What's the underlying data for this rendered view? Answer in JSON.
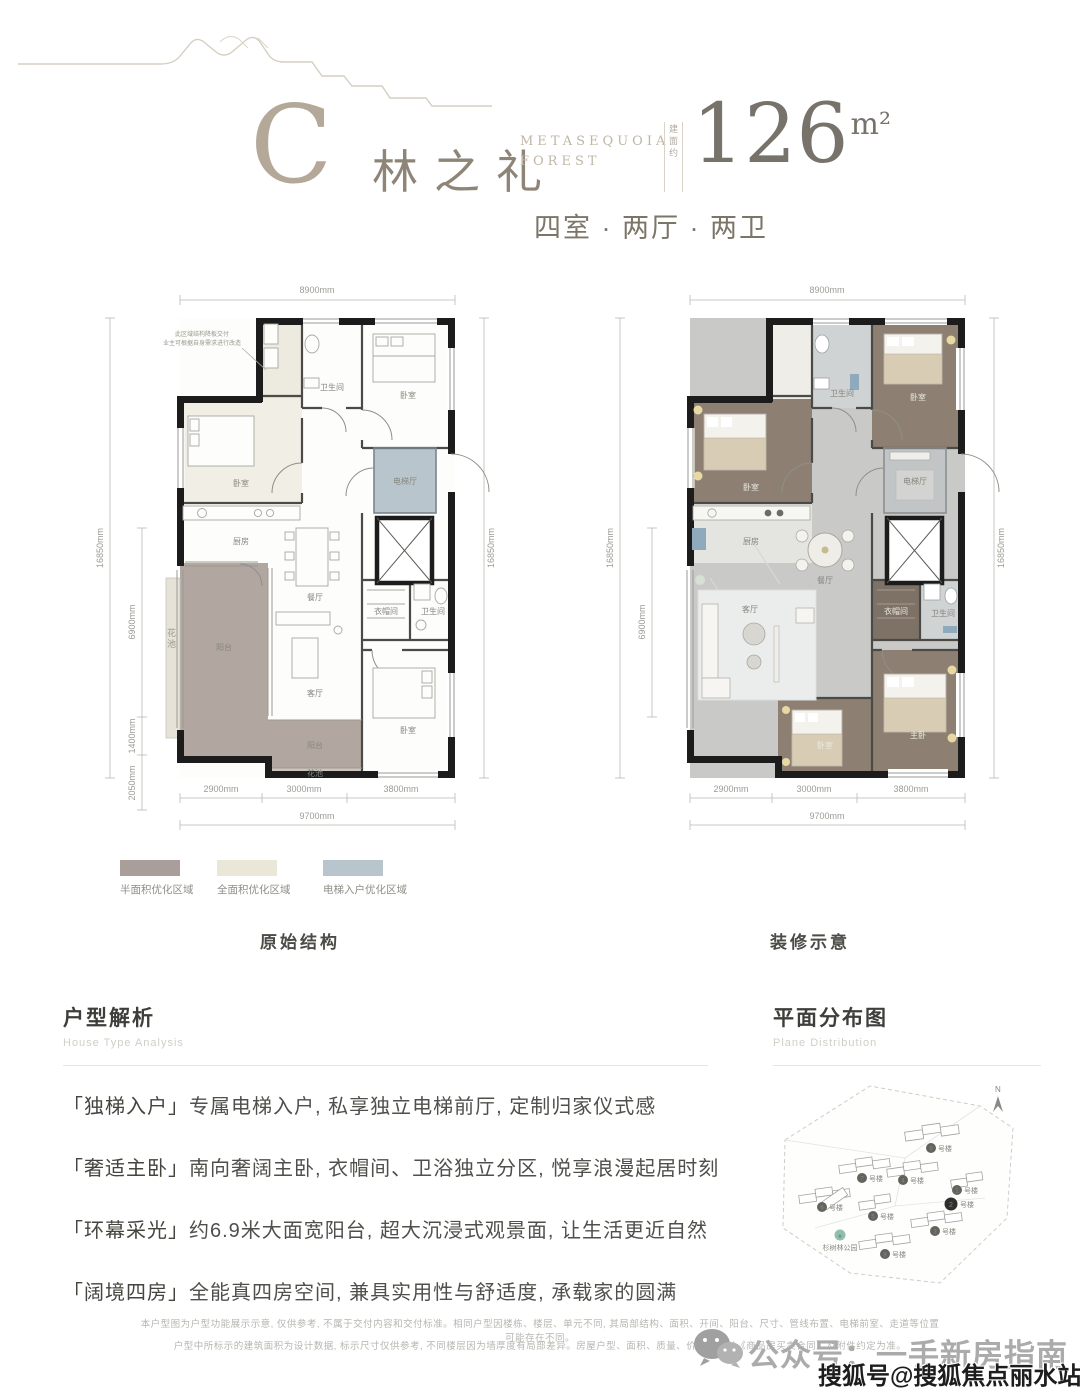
{
  "header": {
    "letter": "C",
    "name": "林之礼",
    "en_line1": "METASEQUOIA",
    "en_line2": "FOREST",
    "area_prefix": "建面约",
    "area_value": "126",
    "area_unit": "m²",
    "layout": "四室 · 两厅 · 两卫"
  },
  "plans": {
    "left": {
      "caption": "原始结构",
      "dims": {
        "top": "8900mm",
        "side": "16850mm",
        "side_inner": [
          "6900mm",
          "1400mm",
          "2050mm"
        ],
        "side_right": "16850mm",
        "bottom": [
          "2900mm",
          "3000mm",
          "3800mm"
        ],
        "bottom_total": "9700mm"
      },
      "note_line1": "此区域结构降板交付",
      "note_line2": "业主可根据自身需求进行改造",
      "rooms": {
        "bath_top": "卫生间",
        "bed_top": "卧室",
        "bed_left": "卧室",
        "kitchen": "厨房",
        "dining": "餐厅",
        "lift_hall": "电梯厅",
        "balcony": "阳台",
        "living": "客厅",
        "cloak": "衣帽间",
        "bath_mid": "卫生间",
        "bed_bottom": "卧室",
        "balcony_south": "阳台",
        "flower_south": "花池",
        "flower_west": "花池"
      }
    },
    "right": {
      "caption": "装修示意",
      "dims": {
        "top": "8900mm",
        "side": "16850mm",
        "side_inner": [
          "6900mm"
        ],
        "side_right": "16850mm",
        "bottom": [
          "2900mm",
          "3000mm",
          "3800mm"
        ],
        "bottom_total": "9700mm"
      },
      "rooms": {
        "bath_top": "卫生间",
        "bed_top_left": "卧室",
        "bed_top_right": "卧室",
        "kitchen": "厨房",
        "dining": "餐厅",
        "lift_hall": "电梯厅",
        "living": "客厅",
        "cloak": "衣帽间",
        "bath_mid": "卫生间",
        "bed_bottom_left": "卧室",
        "master": "主卧"
      }
    }
  },
  "legend": {
    "items": [
      {
        "label": "半面积优化区域",
        "color": "#a99e99"
      },
      {
        "label": "全面积优化区域",
        "color": "#eae7d9"
      },
      {
        "label": "电梯入户优化区域",
        "color": "#b9c5cd"
      }
    ]
  },
  "analysis": {
    "title": "户型解析",
    "subtitle": "House Type Analysis",
    "items": [
      {
        "tag": "「独梯入户」",
        "text": "专属电梯入户, 私享独立电梯前厅, 定制归家仪式感"
      },
      {
        "tag": "「奢适主卧」",
        "text": "南向奢阔主卧, 衣帽间、卫浴独立分区, 悦享浪漫起居时刻"
      },
      {
        "tag": "「环幕采光」",
        "text": "约6.9米大面宽阳台, 超大沉浸式观景面, 让生活更近自然"
      },
      {
        "tag": "「阔境四房」",
        "text": "全能真四房空间, 兼具实用性与舒适度, 承载家的圆满"
      }
    ]
  },
  "distribution": {
    "title": "平面分布图",
    "subtitle": "Plane Distribution",
    "compass": "N",
    "park": "杉树林公园",
    "buildings": [
      {
        "num": "9",
        "suffix": "号楼"
      },
      {
        "num": "7",
        "suffix": "号楼"
      },
      {
        "num": "4",
        "suffix": "号楼"
      },
      {
        "num": "6",
        "suffix": "号楼"
      },
      {
        "num": "1",
        "suffix": "号楼"
      },
      {
        "num": "2",
        "suffix": "号楼"
      },
      {
        "num": "5",
        "suffix": "号楼"
      },
      {
        "num": "3",
        "suffix": "号楼"
      },
      {
        "num": "8",
        "suffix": "号楼"
      }
    ]
  },
  "footer": {
    "disclaimer_line1": "本户型图为户型功能展示示意, 仅供参考, 不属于交付内容和交付标准。相同户型因楼栋、楼层、单元不同, 其局部结构、面积、开间、阳台、尺寸、管线布置、电梯前室、走道等位置可能存在不同。",
    "disclaimer_line2": "户型中所标示的建筑面积为设计数据, 标示尺寸仅供参考, 不同楼层因为墙厚度有局部差异。房屋户型、面积、质量、价款等均以《商品房买卖合同》及附件约定为准。"
  },
  "watermarks": {
    "wechat": "公众号：一手新房指南",
    "sohu": "搜狐号@搜狐焦点丽水站"
  }
}
